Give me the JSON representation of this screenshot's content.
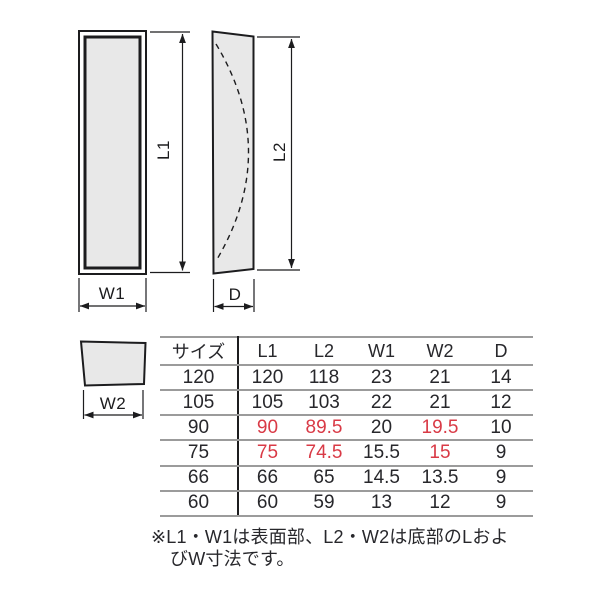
{
  "diagram": {
    "labels": {
      "l1": "L1",
      "l2": "L2",
      "w1": "W1",
      "w2": "W2",
      "d": "D"
    },
    "views": {
      "front_view": "rectangular face with inner panel (L1 x W1)",
      "side_view": "curved-profile side view with dashed arc (L2 x D)",
      "bottom_view": "trapezoid bottom face (W2)"
    },
    "colors": {
      "shape_fill": "#e8e8e8",
      "line": "#1c1c1e",
      "table_rule": "#9b9b9b",
      "text": "#27272b",
      "highlight_red": "#d93a46"
    }
  },
  "table": {
    "columns": [
      "サイズ",
      "L1",
      "L2",
      "W1",
      "W2",
      "D"
    ],
    "rows": [
      [
        "120",
        "120",
        "118",
        "23",
        "21",
        "14"
      ],
      [
        "105",
        "105",
        "103",
        "22",
        "21",
        "12"
      ],
      [
        "90",
        "90",
        "89.5",
        "20",
        "19.5",
        "10"
      ],
      [
        "75",
        "75",
        "74.5",
        "15.5",
        "15",
        "9"
      ],
      [
        "66",
        "66",
        "65",
        "14.5",
        "13.5",
        "9"
      ],
      [
        "60",
        "60",
        "59",
        "13",
        "12",
        "9"
      ]
    ],
    "highlighted_cells": [
      [
        2,
        1
      ],
      [
        2,
        2
      ],
      [
        2,
        4
      ],
      [
        3,
        1
      ],
      [
        3,
        2
      ],
      [
        3,
        4
      ]
    ]
  },
  "note": {
    "line1": "※L1・W1は表面部、L2・W2は底部のLおよ",
    "line2": "びW寸法です。"
  }
}
